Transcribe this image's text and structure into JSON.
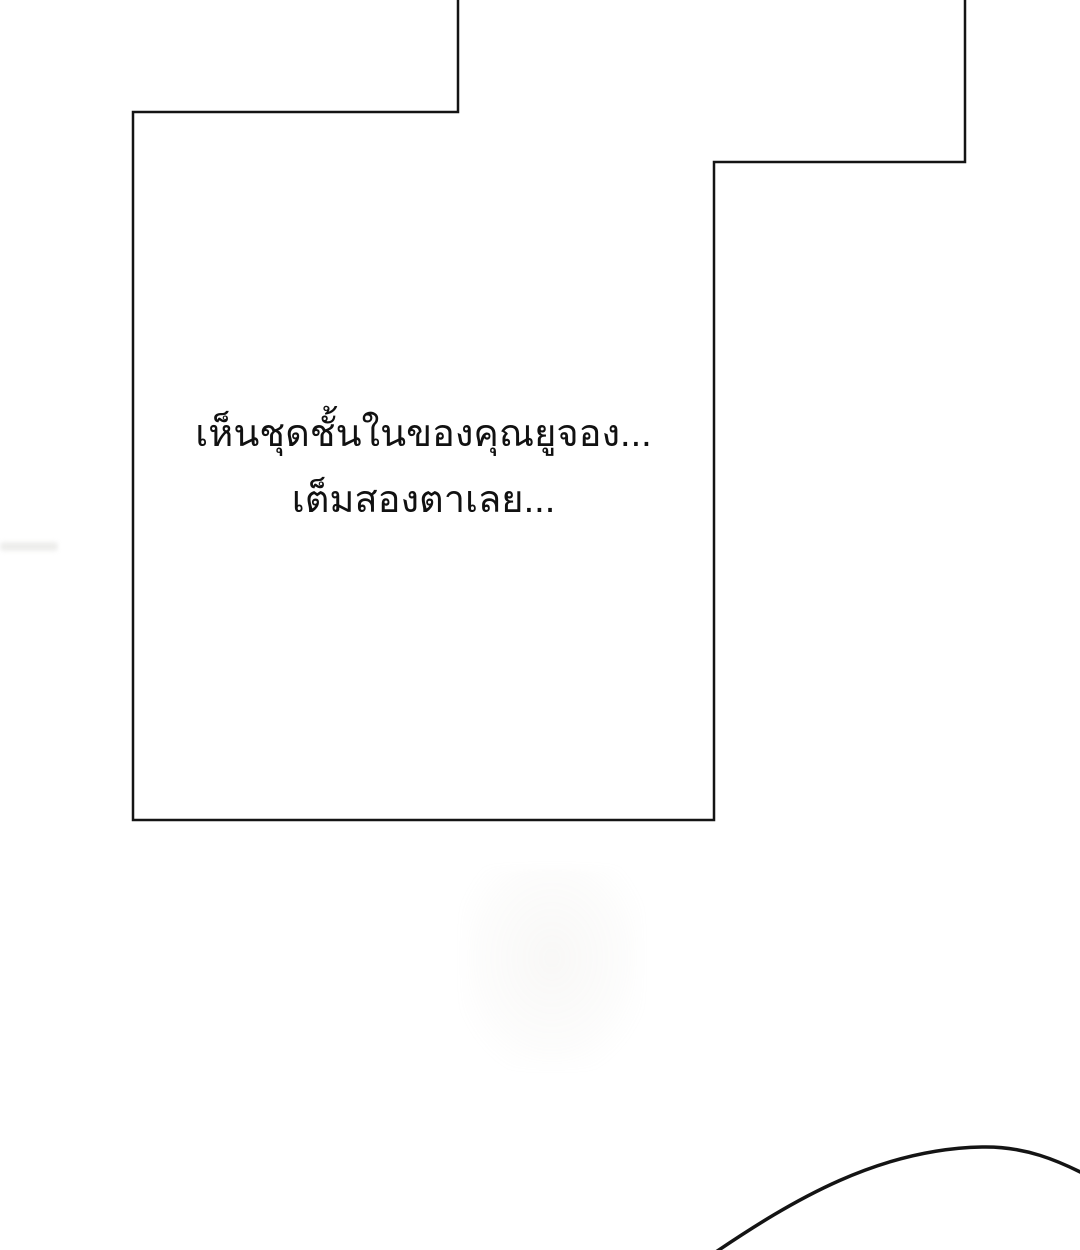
{
  "page": {
    "kind": "webtoon-panel-page",
    "background_color": "#ffffff"
  },
  "panel": {
    "border_color": "#141414",
    "border_width": "2.5",
    "polygon_points": "458,-4 458,112 133,112 133,820 714,820 714,162 965,162 965,-4",
    "dialogue": {
      "line1": "เห็นชุดชั้นในของคุณยูจอง...",
      "line2": "เต็มสองตาเลย...",
      "text_color": "#111111"
    }
  },
  "decor": {
    "bottom_curve_path": "M 710 1256 C 795 1198 880 1149 982 1147 C 1024 1146 1058 1160 1092 1178",
    "curve_color": "#141414",
    "curve_width": "3.5",
    "smudge_color": "#e9e9e7"
  }
}
